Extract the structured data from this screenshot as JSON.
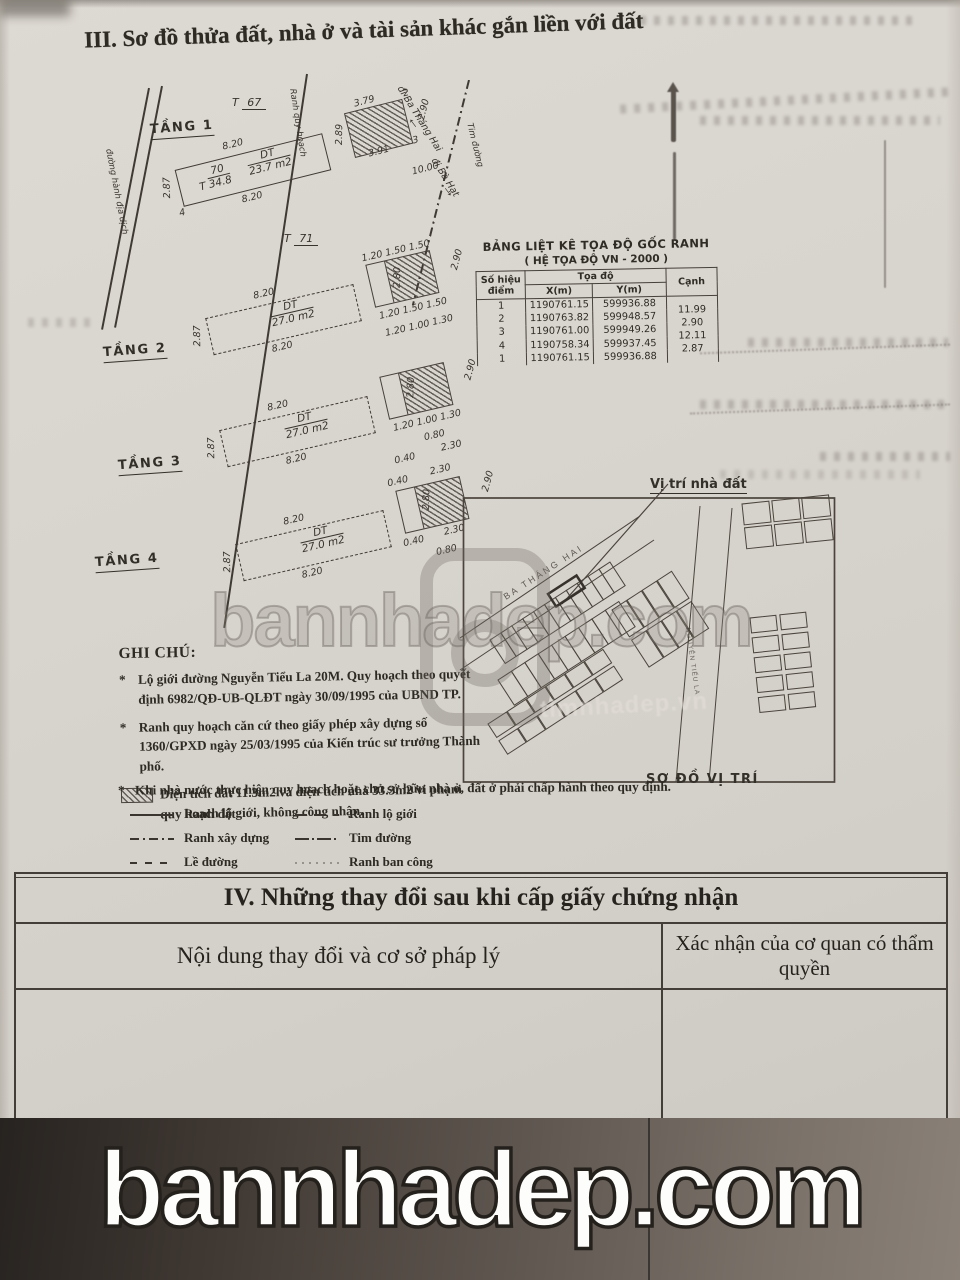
{
  "page": {
    "section3_title": "III. Sơ đồ thửa đất, nhà ở và tài sản khác gắn liền với đất",
    "section4_title": "IV. Những thay đổi sau khi cấp giấy chứng nhận",
    "section4_col1": "Nội dung thay đổi và cơ sở pháp lý",
    "section4_col2": "Xác nhận của cơ quan có thẩm quyền"
  },
  "plan": {
    "street_left": "đường hành địa dịch",
    "boundary_label": "Ranh quy hoạch",
    "center_label": "Tim đường",
    "dir1": "đi Ba Tháng Hai",
    "dir2": "đi Bà Hạt",
    "neighbor_top": {
      "prefix": "T",
      "num": "67"
    },
    "neighbor_bottom": {
      "prefix": "T",
      "num": "71"
    },
    "floors": [
      {
        "name": "TẦNG 1",
        "dt": "DT",
        "area": "23.7 m2",
        "lot_prefix": "T",
        "lot_no": "70",
        "lot_area": "34.8",
        "dims": [
          {
            "t": "8.20",
            "x": 72,
            "y": 8
          },
          {
            "t": "2.87",
            "x": -2,
            "y": 34,
            "r": -78
          },
          {
            "t": "8.20",
            "x": 78,
            "y": 64
          },
          {
            "t": "4",
            "x": 14,
            "y": 62
          },
          {
            "t": "3.79",
            "x": 210,
            "y": -2
          },
          {
            "t": "2",
            "x": 260,
            "y": 0
          },
          {
            "t": "2.89",
            "x": 178,
            "y": 24,
            "r": -75
          },
          {
            "t": "2.90",
            "x": 266,
            "y": 20,
            "r": -62
          },
          {
            "t": "3",
            "x": 258,
            "y": 48
          },
          {
            "t": "3.91",
            "x": 212,
            "y": 50
          },
          {
            "t": "10.00",
            "x": 250,
            "y": 78
          }
        ]
      },
      {
        "name": "TẦNG 2",
        "dt": "DT",
        "area": "27.0 m2",
        "dims": [
          {
            "t": "8.20",
            "x": 72,
            "y": 8
          },
          {
            "t": "2.87",
            "x": -2,
            "y": 34,
            "r": -78
          },
          {
            "t": "8.20",
            "x": 78,
            "y": 64
          },
          {
            "t": "1.20 1.50 1.50",
            "x": 186,
            "y": -4
          },
          {
            "t": "2.90",
            "x": 268,
            "y": 18,
            "r": -62
          },
          {
            "t": "2.80",
            "x": 206,
            "y": 22,
            "r": -75
          },
          {
            "t": "1.20 1.50 1.50",
            "x": 190,
            "y": 56
          },
          {
            "t": "1.20 1.00 1.30",
            "x": 192,
            "y": 74
          }
        ]
      },
      {
        "name": "TẦNG 3",
        "dt": "DT",
        "area": "27.0 m2",
        "dims": [
          {
            "t": "8.20",
            "x": 72,
            "y": 8
          },
          {
            "t": "2.87",
            "x": -2,
            "y": 34,
            "r": -78
          },
          {
            "t": "8.20",
            "x": 78,
            "y": 64
          },
          {
            "t": "2.90",
            "x": 268,
            "y": 16,
            "r": -62
          },
          {
            "t": "2.80",
            "x": 206,
            "y": 20,
            "r": -75
          },
          {
            "t": "1.20 1.00 1.30",
            "x": 190,
            "y": 56
          },
          {
            "t": "0.80",
            "x": 218,
            "y": 72
          },
          {
            "t": "0.40",
            "x": 184,
            "y": 88
          },
          {
            "t": "2.30",
            "x": 232,
            "y": 86
          }
        ]
      },
      {
        "name": "TẦNG 4",
        "dt": "DT",
        "area": "27.0 m2",
        "dims": [
          {
            "t": "0.40",
            "x": 182,
            "y": -6
          },
          {
            "t": "2.30",
            "x": 226,
            "y": -8
          },
          {
            "t": "8.20",
            "x": 72,
            "y": 8
          },
          {
            "t": "2.87",
            "x": -2,
            "y": 34,
            "r": -78
          },
          {
            "t": "8.20",
            "x": 78,
            "y": 64
          },
          {
            "t": "2.90",
            "x": 270,
            "y": 14,
            "r": -62
          },
          {
            "t": "2.80",
            "x": 206,
            "y": 18,
            "r": -75
          },
          {
            "t": "0.40",
            "x": 184,
            "y": 56
          },
          {
            "t": "2.30",
            "x": 226,
            "y": 54
          },
          {
            "t": "0.80",
            "x": 214,
            "y": 72
          }
        ]
      }
    ]
  },
  "coord_table": {
    "title": "BẢNG LIỆT KÊ TỌA ĐỘ GỐC RANH",
    "subtitle": "( HỆ TỌA ĐỘ VN - 2000 )",
    "col_point": "Số hiệu điểm",
    "col_coord": "Tọa độ",
    "col_x": "X(m)",
    "col_y": "Y(m)",
    "col_edge": "Cạnh",
    "rows": [
      {
        "p": "1",
        "x": "1190761.15",
        "y": "599936.88"
      },
      {
        "p": "2",
        "x": "1190763.82",
        "y": "599948.57"
      },
      {
        "p": "3",
        "x": "1190761.00",
        "y": "599949.26"
      },
      {
        "p": "4",
        "x": "1190758.34",
        "y": "599937.45"
      },
      {
        "p": "1",
        "x": "1190761.15",
        "y": "599936.88"
      }
    ],
    "edges": [
      "11.99",
      "2.90",
      "12.11",
      "2.87"
    ]
  },
  "map": {
    "pointer_label": "Vị trí nhà đất",
    "street_diagonal": "BA THÁNG HAI",
    "street_vertical": "NGUYỄN TIỂU LA",
    "caption": "SƠ ĐỒ VỊ TRÍ"
  },
  "notes": {
    "heading": "GHI CHÚ:",
    "marker": "*",
    "items": [
      "Lộ giới đường Nguyễn Tiểu La 20M. Quy hoạch theo quyết định 6982/QĐ-UB-QLĐT ngày 30/09/1995 của UBND TP.",
      "Ranh quy hoạch căn cứ theo giấy phép xây dựng số 1360/GPXD ngày 25/03/1995 của Kiến trúc sư trưởng Thành phố.",
      "Diện tích đất 11.3m2 và diện tích nhà 33.3m2 vi phạm quy hoạch lộ giới, không công nhận.",
      "Khi nhà nước thực hiện quy hoạch hoặc chủ sở hữu nhà ở, đất ở phải chấp hành theo quy định."
    ]
  },
  "legend": {
    "items": [
      {
        "style": "solid",
        "label": "Ranh đất"
      },
      {
        "style": "longdash",
        "label": "Ranh lộ giới"
      },
      {
        "style": "dashdot",
        "label": "Ranh xây dựng"
      },
      {
        "style": "center",
        "label": "Tim đường"
      },
      {
        "style": "shortdash",
        "label": "Lề đường"
      },
      {
        "style": "dotted",
        "label": "Ranh ban công"
      }
    ]
  },
  "watermarks": {
    "big": "bannhadep.com",
    "mid": "bannhadep.com",
    "faint": "timnhadep.vn"
  },
  "colors": {
    "paper": "#d8d4ce",
    "ink": "#3a362f",
    "band": "#453d37"
  }
}
